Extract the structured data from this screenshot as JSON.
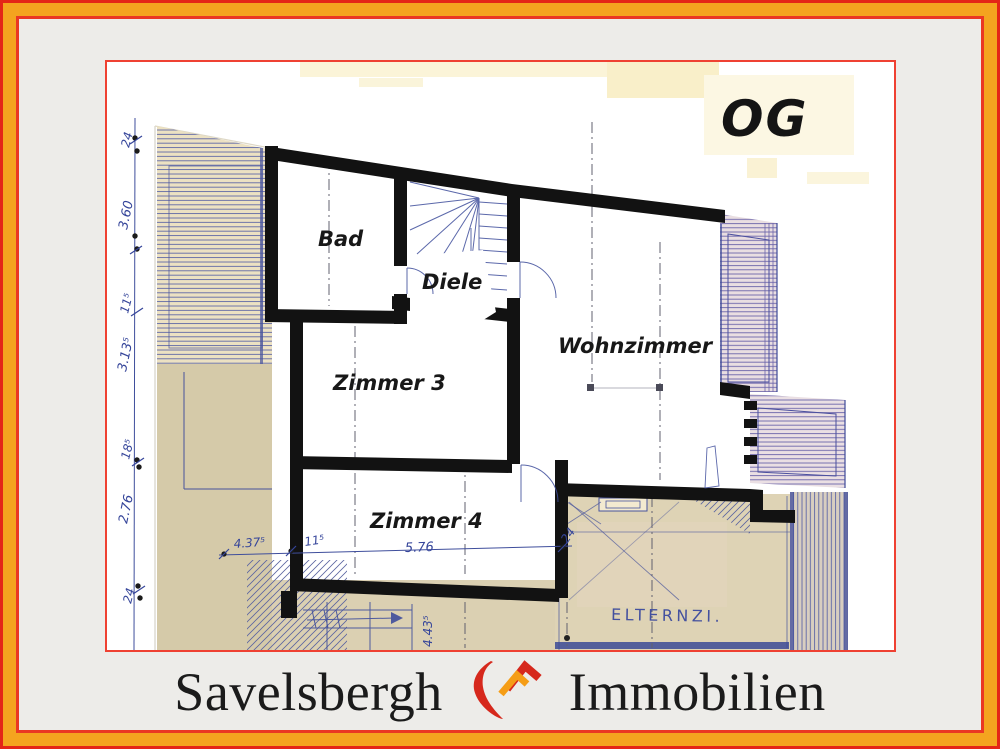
{
  "frame": {
    "outer_border_color": "#e42617",
    "orange_band_color": "#f4a41f",
    "inner_border_color": "#ea3823",
    "background_color": "#edece9",
    "panel_border_color": "#ef4132"
  },
  "plan": {
    "floor_label": "OG",
    "rooms": {
      "bad": "Bad",
      "diele": "Diele",
      "zimmer3": "Zimmer 3",
      "zimmer4": "Zimmer 4",
      "wohnzimmer": "Wohnzimmer",
      "elternzimmer": "ELTERNZI."
    },
    "dims": {
      "left_chain": [
        "24",
        "3.60",
        "11⁵",
        "3.13⁵",
        "18⁵",
        "2.76",
        "24"
      ],
      "bottom_chain": [
        "4.37⁵",
        "11⁵",
        "5.76",
        "24"
      ],
      "stair_width": "4.43⁵"
    },
    "ink_color": "#3f4e9c",
    "wall_color": "#121212"
  },
  "branding": {
    "word_left": "Savelsbergh",
    "word_right": "Immobilien",
    "logo": "house-roof-swoosh",
    "logo_red": "#d6281c",
    "logo_orange": "#f59d16"
  }
}
